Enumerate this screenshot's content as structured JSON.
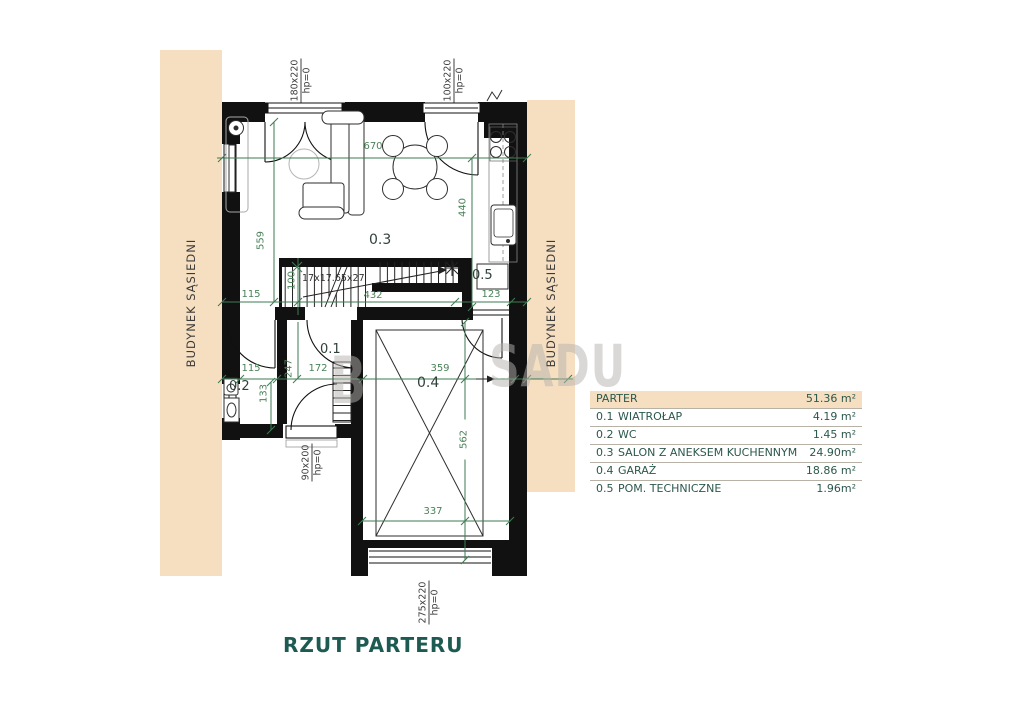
{
  "title": "RZUT PARTERU",
  "neighbor_building_label": "BUDYNEK SĄSIEDNI",
  "watermark": {
    "left": "B",
    "right": "SADU"
  },
  "legend": {
    "header": {
      "label": "PARTER",
      "area": "51.36 m²"
    },
    "rows": [
      {
        "id": "0.1",
        "name": "WIATROŁAP",
        "area": "4.19 m²"
      },
      {
        "id": "0.2",
        "name": "WC",
        "area": "1.45 m²"
      },
      {
        "id": "0.3",
        "name": "SALON Z ANEKSEM KUCHENNYM",
        "area": "24.90m²"
      },
      {
        "id": "0.4",
        "name": "GARAŻ",
        "area": "18.86 m²"
      },
      {
        "id": "0.5",
        "name": "POM. TECHNICZNE",
        "area": "1.96m²"
      }
    ]
  },
  "plan": {
    "stairs_label": "17x17.65x27",
    "dimensions": {
      "top_width": "670",
      "living_height": "559",
      "kitchen_height": "440",
      "hall_115": "115",
      "stairs_100": "100",
      "hall_432": "432",
      "hall_123": "123",
      "low_115": "115",
      "low_247": "247",
      "low_172": "172",
      "garage_width": "359",
      "wc_133": "133",
      "garage_height": "562",
      "garage_door_width": "337"
    },
    "openings": {
      "window_top": {
        "size": "180x220",
        "sill": "hp=0"
      },
      "door_top": {
        "size": "100x220",
        "sill": "hp=0"
      },
      "door_entry": {
        "size": "90x200",
        "sill": "hp=0"
      },
      "garage_door": {
        "size": "275x220",
        "sill": "hp=0"
      }
    }
  },
  "colors": {
    "beige": "#f5dfc0",
    "dimension_green": "#3e7b51",
    "teal": "#1d5a52",
    "wall": "#111111",
    "watermark_gray": "#b7b3ae"
  }
}
